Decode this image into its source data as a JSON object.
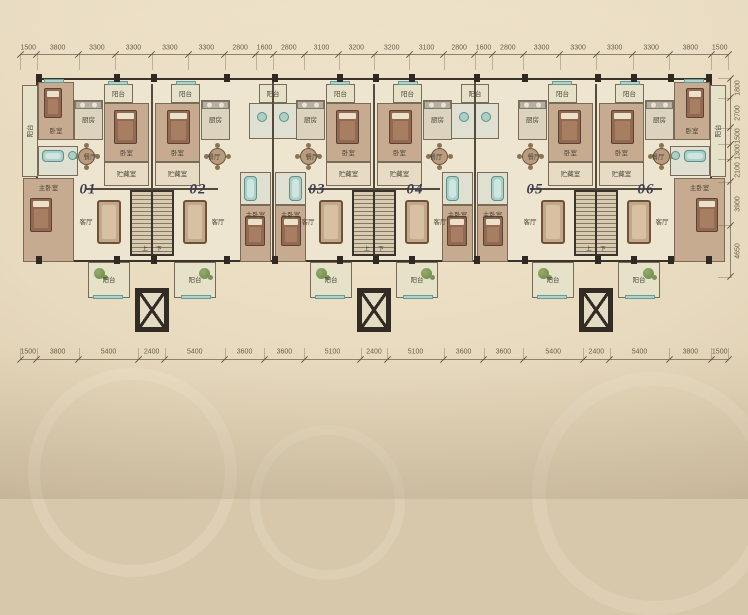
{
  "page": {
    "description": "residential floor plan, six units",
    "bg_outer": "#c5b495",
    "bg_inner": "#efe3ca"
  },
  "dimensions": {
    "top": [
      1500,
      3800,
      3300,
      3300,
      3300,
      3300,
      2800,
      1600,
      2800,
      3100,
      3200,
      3200,
      3100,
      2800,
      1600,
      2800,
      3300,
      3300,
      3300,
      3300,
      3800,
      1500
    ],
    "bottom": [
      1500,
      3800,
      5400,
      2400,
      5400,
      3600,
      3600,
      5100,
      2400,
      5100,
      3600,
      3600,
      5400,
      2400,
      5400,
      3800,
      1500
    ],
    "right": [
      1800,
      2700,
      1500,
      1300,
      2100,
      3900,
      4650
    ],
    "total_width_mm": 64000,
    "total_depth_mm": 17950
  },
  "units": [
    {
      "id": "01",
      "cx": 88,
      "cy": 190
    },
    {
      "id": "02",
      "cx": 198,
      "cy": 190
    },
    {
      "id": "03",
      "cx": 317,
      "cy": 190
    },
    {
      "id": "04",
      "cx": 415,
      "cy": 190
    },
    {
      "id": "05",
      "cx": 535,
      "cy": 190
    },
    {
      "id": "06",
      "cx": 646,
      "cy": 190
    }
  ],
  "room_names": {
    "balcony": "阳台",
    "living": "客厅",
    "dining": "餐厅",
    "kitchen": "厨房",
    "bedroom": "卧室",
    "master_bedroom": "主卧室",
    "storage": "贮藏室",
    "stair_up": "上",
    "stair_down": "下"
  },
  "plan": {
    "pair_axes": [
      152,
      374,
      596
    ],
    "between_axes": [
      273,
      475
    ]
  },
  "colors": {
    "wall": "#3a332b",
    "dim_text": "#665e4c",
    "dim_line": "#8d8270",
    "unit_number": "#3c3e52",
    "label_text": "#4e463a",
    "teal_fixture": "#abd0c8",
    "wood_floor": "#c6ab90",
    "plant_green": "#7a9455"
  }
}
